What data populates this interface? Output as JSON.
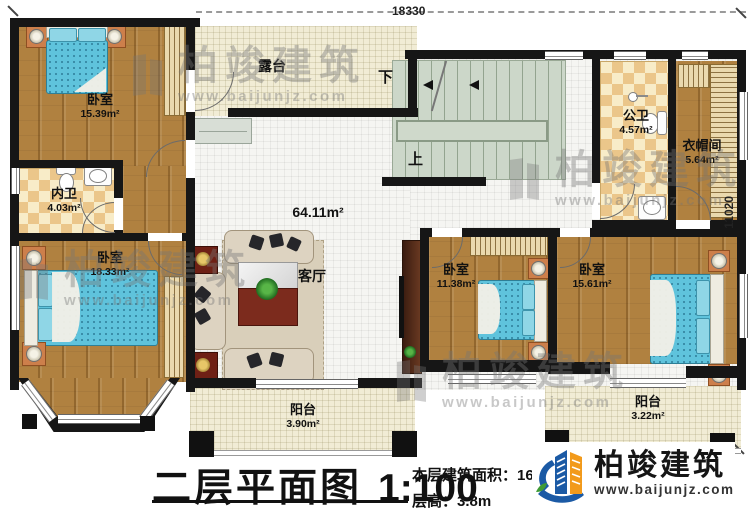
{
  "plan": {
    "dim_top": "18330",
    "dim_right": "11020",
    "stair_down": "下",
    "stair_up": "上",
    "hall_area": "64.11m²",
    "rooms": {
      "bedroom_tl": {
        "name": "卧室",
        "area": "15.39m²"
      },
      "inner_bath": {
        "name": "内卫",
        "area": "4.03m²"
      },
      "bedroom_bl": {
        "name": "卧室",
        "area": "18.33m²"
      },
      "terrace": {
        "name": "露台"
      },
      "living": {
        "name": "客厅"
      },
      "public_bath": {
        "name": "公卫",
        "area": "4.57m²"
      },
      "cloakroom": {
        "name": "衣帽间",
        "area": "5.64m²"
      },
      "bedroom_mid": {
        "name": "卧室",
        "area": "11.38m²"
      },
      "bedroom_br": {
        "name": "卧室",
        "area": "15.61m²"
      },
      "balcony_left": {
        "name": "阳台",
        "area": "3.90m²"
      },
      "balcony_right": {
        "name": "阳台",
        "area": "3.22m²"
      }
    }
  },
  "footer": {
    "title": "二层平面图",
    "scale": "1:100",
    "area_label": "本层建筑面积：169.12㎡",
    "height_label": "层高：3.8m",
    "brand": "柏竣建筑",
    "brand_url": "www.baijunjz.com",
    "brand_color": "#1b5aa5",
    "accent_color": "#f29a1b"
  },
  "watermark": {
    "brand": "柏竣建筑",
    "url": "www.baijunjz.com"
  }
}
